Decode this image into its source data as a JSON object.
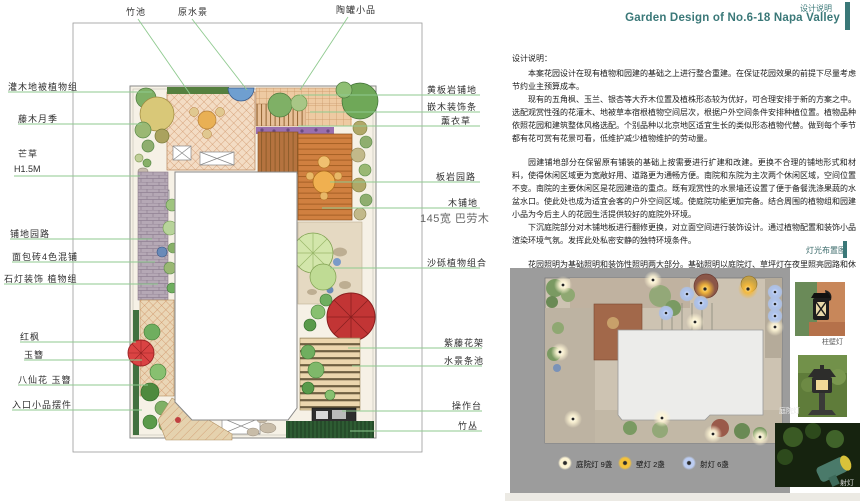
{
  "header": {
    "tag": "设计说明",
    "title": "Garden Design of  No.6-18 Napa Valley",
    "accent_color": "#3a7878"
  },
  "plan": {
    "top_labels": [
      "竹池",
      "原水景",
      "陶罐小品"
    ],
    "left_labels": [
      "灌木地被植物组",
      "藤木月季",
      "芒草",
      "H1.5M",
      "铺地园路",
      "面包砖4色混铺",
      "石灯装饰  植物组",
      "红枫",
      "玉簪",
      "八仙花  玉簪",
      "入口小品摆件"
    ],
    "right_labels": [
      "黄板岩铺地",
      "嵌木装饰条",
      "薰衣草",
      "板岩园路",
      "木铺地",
      "145宽  巴劳木",
      "沙砾植物组合",
      "紫藤花架",
      "水景条池",
      "操作台",
      "竹丛"
    ],
    "leader_color": "#8fca8f"
  },
  "description": {
    "heading": "设计说明：",
    "paragraphs": [
      "本案花园设计在现有植物和园建的基础之上进行整合重建。在保证花园效果的前提下尽量考虑节约业主预算成本。",
      "现有的五角枫、玉兰、银杏等大乔木位置及植株形态较为优好，可合理安排于新的方案之中。选配观赏性强的花灌木、地被草本宿根植物空间层次，根据户外空间条件安排种植位置。植物品种依照花园和建筑整体风格选配。个别品种以北京地区适宜生长的类似形态植物代替。做到每个季节都有花可赏有花景可看，低维护减少植物维护的劳动量。",
      "园建铺地部分在保留原有铺装的基础上按需要进行扩建和改建。更换不合理的铺地形式和材料，使得休闲区域更为宽敞好用、道路更为通畅方便。南院和东院为主次两个休闲区域，空间位置不变。南院的主要休闲区是花园建造的重点。既有观赏性的水景墙还设置了便于备餐洗涤果蔬的水盆水口。使此处也成为适宜会客的户外空间区域。使庭院功能更加完备。结合周围的植物组和园建小品为今后主人的花园生活提供较好的庭院外环境。",
      "下沉庭院部分对木铺地板进行翻修更换，对立面空间进行装饰设计。通过植物配置和装饰小品渲染环境气氛。发挥此处私密安静的独特环境条件。",
      "花园照明为基础照明和装饰性照明两大部分。基础照明以庭院灯、草坪灯在夜里照亮园路和休闲区域。再配以装饰射灯渲染夜景氛围。",
      "花园灌溉重新铺设地下管线，在绿地各处设置灌溉水口，方便浇灌园地。"
    ]
  },
  "lighting": {
    "section_label": "灯光布置图",
    "panel_color": "#9c9c9c",
    "legend": [
      {
        "label": "庭院灯",
        "count": "9盏",
        "color": "#fdf4d4"
      },
      {
        "label": "壁灯",
        "count": "2盏",
        "color": "#f4c23a"
      },
      {
        "label": "射灯",
        "count": "6盏",
        "color": "#bccdf2"
      }
    ]
  },
  "photos": [
    {
      "label": "柱壁灯"
    },
    {
      "label": "庭院灯"
    },
    {
      "label": "射灯"
    }
  ]
}
